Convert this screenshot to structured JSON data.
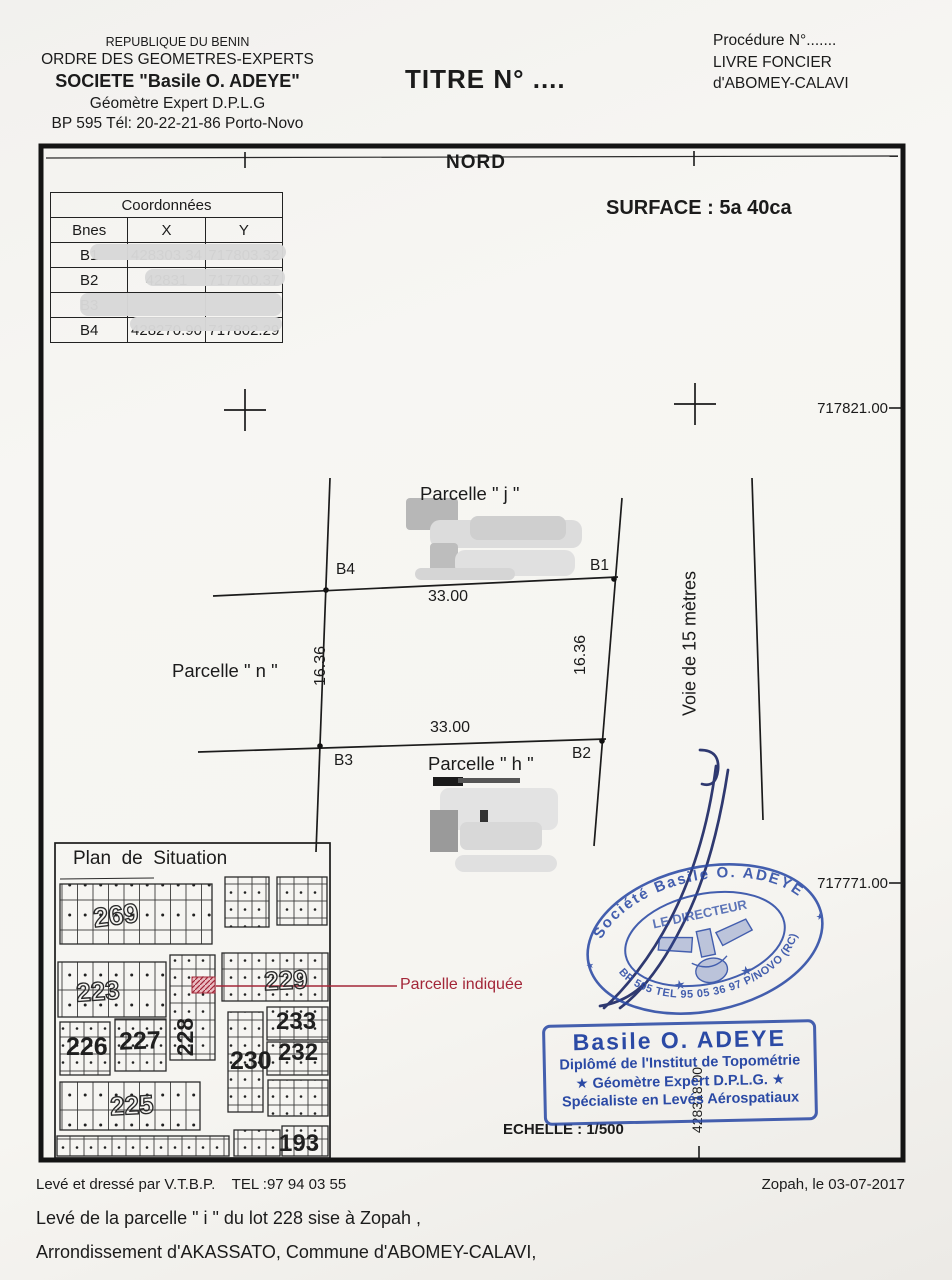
{
  "header": {
    "org_line1": "REPUBLIQUE DU BENIN",
    "org_line2": "ORDRE DES GEOMETRES-EXPERTS",
    "org_line3": "SOCIETE \"Basile O. ADEYE\"",
    "org_line4": "Géomètre Expert D.P.L.G",
    "org_line5": "BP 595 Tél: 20-22-21-86 Porto-Novo",
    "title": "TITRE N° ....",
    "procedure": "Procédure N°.......",
    "livre": "LIVRE FONCIER",
    "commune": "d'ABOMEY-CALAVI"
  },
  "plan": {
    "north": "NORD",
    "surface": "SURFACE : 5a 40ca",
    "table": {
      "title": "Coordonnées",
      "col_bnes": "Bnes",
      "col_x": "X",
      "col_y": "Y",
      "rows": [
        {
          "b": "B1",
          "x": "428303.34",
          "y": "717803.32"
        },
        {
          "b": "B2",
          "x": "42831",
          "y": "717700.37"
        },
        {
          "b": "B3",
          "x": "",
          "y": ""
        },
        {
          "b": "B4",
          "x": "428270.90",
          "y": "717802.29"
        }
      ]
    },
    "grid": {
      "right_top": "717821.00",
      "right_bottom": "717771.00",
      "bottom": "428318.00"
    },
    "parcel_j": "Parcelle \" j \"",
    "parcel_n": "Parcelle \" n \"",
    "parcel_h": "Parcelle \" h \"",
    "b1": "B1",
    "b2": "B2",
    "b3": "B3",
    "b4": "B4",
    "dim_top": "33.00",
    "dim_bottom": "33.00",
    "dim_left": "16.36",
    "dim_right": "16.36",
    "road": "Voie de 15 mètres",
    "situation_title": "Plan  de  Situation",
    "lots": [
      "269",
      "223",
      "229",
      "228",
      "226",
      "227",
      "230",
      "233",
      "232",
      "225",
      "193"
    ],
    "indicated": "Parcelle indiquée",
    "echelle": "ECHELLE : 1/500"
  },
  "stamps": {
    "oval_top": "Société Basile O. ADEYE",
    "oval_center": "LE DIRECTEUR",
    "oval_bottom": "BP 595 TEL 95 05 36 97 P/NOVO (RC)",
    "box_name": "Basile O. ADEYE",
    "box_line2": "Diplômé de l'Institut de Topométrie",
    "box_line3": "★ Géomètre Expert D.P.L.G. ★",
    "box_line4": "Spécialiste en Levés Aérospatiaux"
  },
  "footer": {
    "left": "Levé et dressé par V.T.B.P.    TEL :97 94 03 55",
    "right": "Zopah, le 03-07-2017",
    "line1": "Levé de la  parcelle \" i \" du lot 228 sise à Zopah ,",
    "line2": "Arrondissement d'AKASSATO, Commune d'ABOMEY-CALAVI,"
  },
  "colors": {
    "ink": "#1b1b1b",
    "stamp_blue": "#2b4aa5",
    "signature_blue": "#1f2a66",
    "indicator_red": "#a32638",
    "redaction_gray": "#d6d6d6"
  }
}
